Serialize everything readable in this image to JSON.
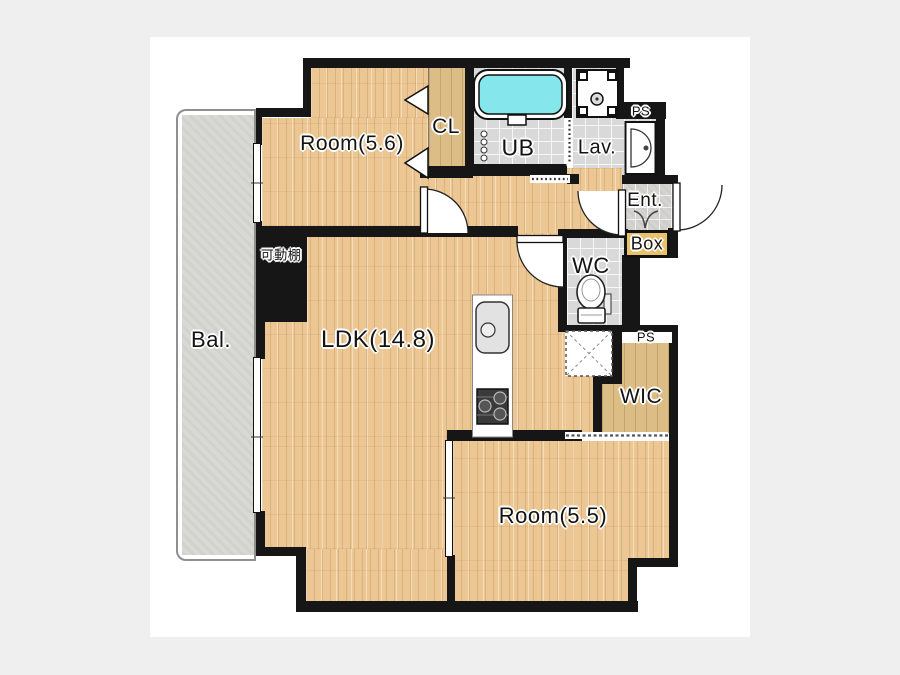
{
  "floorplan": {
    "labels": {
      "balcony": "Bal.",
      "room_upper": "Room(5.6)",
      "closet": "CL",
      "unit_bath": "UB",
      "lavatory": "Lav.",
      "pipe_space_top": "PS",
      "entrance": "Ent.",
      "box": "Box",
      "toilet_room": "WC",
      "living": "LDK(14.8)",
      "pipe_space_bottom": "PS",
      "walk_in_closet": "WIC",
      "room_lower": "Room(5.5)",
      "movable_shelf": "可動棚"
    },
    "colors": {
      "background": "#efefef",
      "canvas": "#ffffff",
      "wall": "#161616",
      "wood_floor": "#ecc794",
      "closet_floor": "#dcbd85",
      "tile_floor": "#d9d9d9",
      "entrance_tile": "#d4d3cf",
      "balcony_floor": "#d8d8d4",
      "bathtub_fill": "#85e6ec",
      "box_fill": "#e8c268"
    }
  }
}
